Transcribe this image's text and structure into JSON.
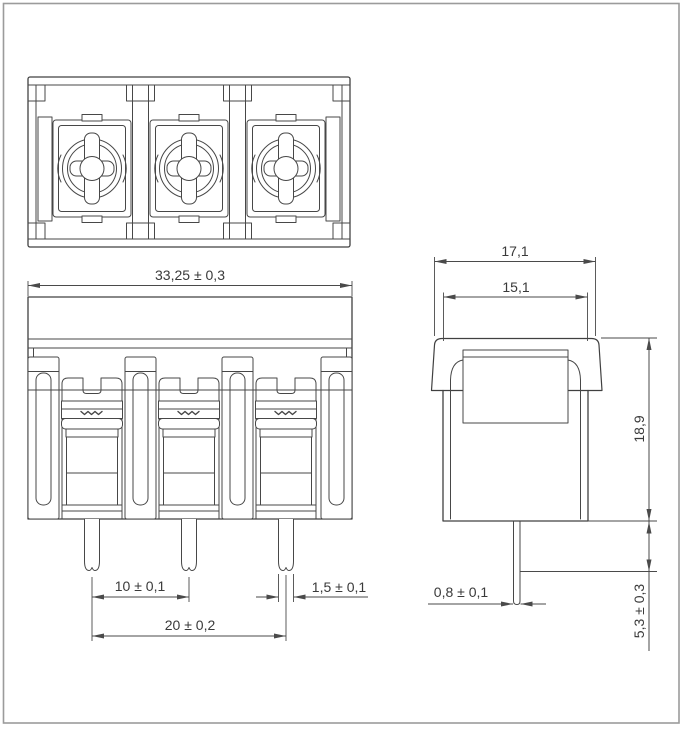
{
  "meta": {
    "background_color": "#ffffff",
    "line_color": "#404040",
    "dimension_color": "#4a4a4a",
    "page_border_color": "#9b9b9b",
    "drawing_subject": "3-pole barrier terminal block",
    "views": [
      "top view",
      "front view",
      "side view"
    ]
  },
  "dimensions": {
    "front_overall_width": {
      "label": "33,25 ± 0,3",
      "value": 33.25,
      "tolerance": 0.3
    },
    "pin_pitch": {
      "label": "10 ± 0,1",
      "value": 10,
      "tolerance": 0.1
    },
    "outer_pin_span": {
      "label": "20 ± 0,2",
      "value": 20,
      "tolerance": 0.2
    },
    "pin_width": {
      "label": "1,5 ± 0,1",
      "value": 1.5,
      "tolerance": 0.1
    },
    "side_overall_width": {
      "label": "17,1",
      "value": 17.1
    },
    "side_body_width": {
      "label": "15,1",
      "value": 15.1
    },
    "body_height": {
      "label": "18,9",
      "value": 18.9
    },
    "pin_thickness": {
      "label": "0,8 ± 0,1",
      "value": 0.8,
      "tolerance": 0.1
    },
    "pin_length": {
      "label": "5,3 ± 0,3",
      "value": 5.3,
      "tolerance": 0.3
    }
  }
}
